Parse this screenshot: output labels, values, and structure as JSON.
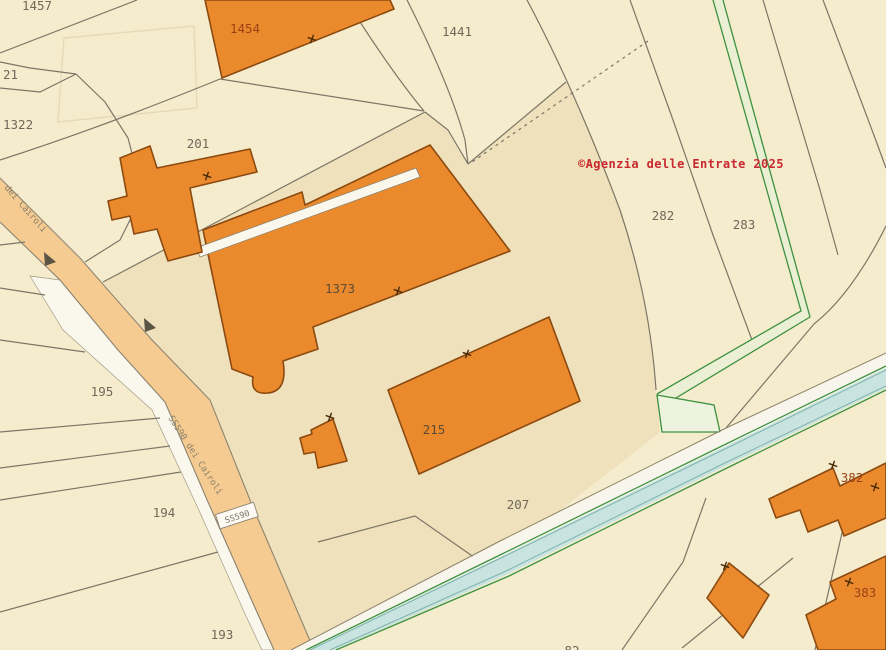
{
  "map": {
    "copyright": "©Agenzia delle Entrate 2025",
    "road": {
      "shield": "SS590",
      "name": "SS590 dei Cairoli",
      "name_upper": "dei Cairoli"
    },
    "parcel_labels": [
      {
        "text": "1457",
        "x": 37,
        "y": 10,
        "anchor": "middle"
      },
      {
        "text": "21",
        "x": 3,
        "y": 79,
        "anchor": "start"
      },
      {
        "text": "1322",
        "x": 3,
        "y": 129,
        "anchor": "start"
      },
      {
        "text": "201",
        "x": 198,
        "y": 148,
        "anchor": "middle"
      },
      {
        "text": "1441",
        "x": 457,
        "y": 36,
        "anchor": "middle"
      },
      {
        "text": "282",
        "x": 663,
        "y": 220,
        "anchor": "middle"
      },
      {
        "text": "283",
        "x": 744,
        "y": 229,
        "anchor": "middle"
      },
      {
        "text": "195",
        "x": 102,
        "y": 396,
        "anchor": "middle"
      },
      {
        "text": "194",
        "x": 164,
        "y": 517,
        "anchor": "middle"
      },
      {
        "text": "193",
        "x": 222,
        "y": 639,
        "anchor": "middle"
      },
      {
        "text": "207",
        "x": 518,
        "y": 509,
        "anchor": "middle"
      },
      {
        "text": "82",
        "x": 572,
        "y": 655,
        "anchor": "middle"
      }
    ],
    "building_labels": [
      {
        "text": "1454",
        "x": 245,
        "y": 33,
        "tone": "rust"
      },
      {
        "text": "1373",
        "x": 340,
        "y": 293,
        "tone": "dark"
      },
      {
        "text": "215",
        "x": 434,
        "y": 434,
        "tone": "dark"
      },
      {
        "text": "382",
        "x": 852,
        "y": 482,
        "tone": "rust"
      },
      {
        "text": "383",
        "x": 865,
        "y": 597,
        "tone": "rust"
      }
    ],
    "colors": {
      "background": "#F5ECCE",
      "courtyard": "#EFE1BC",
      "road_fill": "#F6CB92",
      "parcel_line": "#7C7666",
      "boundary_green": "#3D9140",
      "water": "#C9E4E0",
      "building_fill": "#EB8A2D",
      "building_stroke": "#8B4A10",
      "label_grey": "#6F695A",
      "label_dark": "#5E4B36",
      "label_rust": "#9A4214",
      "copyright_red": "#C9292E"
    }
  }
}
